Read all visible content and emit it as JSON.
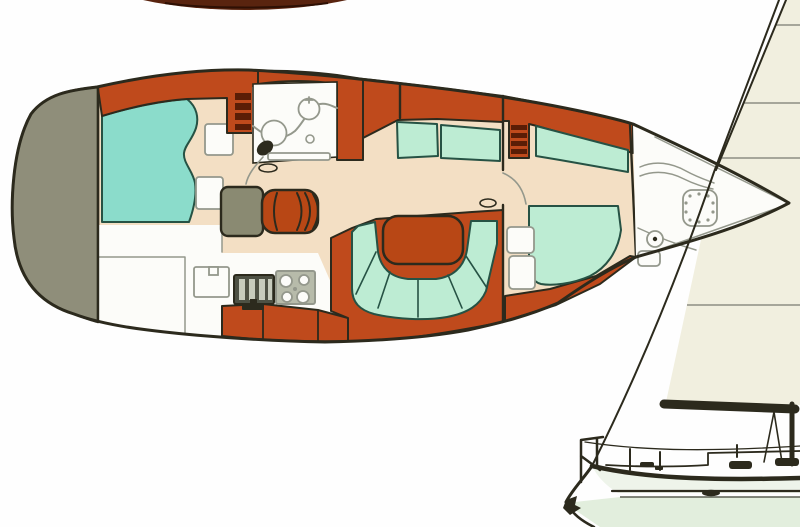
{
  "figure": {
    "kind": "scanned-yacht-brochure-diagram",
    "views": [
      "interior-floorplan-top-view",
      "sailboat-profile-side-view"
    ],
    "orientation": "bow-right",
    "visible_text": []
  },
  "palette": {
    "background": "#fefefe",
    "ink": "#2c2a1d",
    "line_gray": "#94988c",
    "sole_beige": "#f3dfc4",
    "joinery_orange": "#bf4a1c",
    "rung_dark": "#5a1d06",
    "berth_aqua": "#8bdccb",
    "cushion_mint": "#bdecd3",
    "cushion_edge": "#265244",
    "stern_gray": "#8f8e7a",
    "desk_olive": "#8a8a72",
    "surface_white": "#fcfcf9",
    "stove_dark": "#4e5144",
    "stove_bar": "#c7cbbc",
    "burner_gray": "#b7bbaa",
    "table_orange": "#b84715",
    "sail_cream": "#f1efdf",
    "sail_seam": "#8e8e84",
    "hull_side": "#eef4ea",
    "hull_bottom": "#e2eedd",
    "cropped_hull": "#59240f",
    "cropped_hull_line": "#2e1004"
  },
  "floorplan": {
    "regions": [
      {
        "name": "stern-swim-platform",
        "color_key": "stern_gray"
      },
      {
        "name": "aft-cabin-berth",
        "color_key": "berth_aqua"
      },
      {
        "name": "aft-compartment",
        "color_key": "surface_white"
      },
      {
        "name": "companionway-steps",
        "color_key": "joinery_orange"
      },
      {
        "name": "head-compartment",
        "color_key": "surface_white"
      },
      {
        "name": "nav-station",
        "color_key": "desk_olive"
      },
      {
        "name": "galley",
        "color_key": "surface_white"
      },
      {
        "name": "port-settee",
        "color_key": "cushion_mint"
      },
      {
        "name": "u-shaped-settee",
        "color_key": "cushion_mint"
      },
      {
        "name": "salon-table",
        "color_key": "table_orange"
      },
      {
        "name": "forward-cabin-berth",
        "color_key": "cushion_mint"
      },
      {
        "name": "forward-louvered-locker",
        "color_key": "joinery_orange"
      },
      {
        "name": "forepeak-anchor-locker",
        "color_key": "surface_white"
      }
    ]
  },
  "side_view": {
    "elements": [
      "headsail",
      "forestay",
      "boom",
      "mast",
      "mainsheet",
      "bow-pulpit",
      "anchor",
      "deck-hatches",
      "stanchions",
      "waterline",
      "porthole"
    ]
  }
}
